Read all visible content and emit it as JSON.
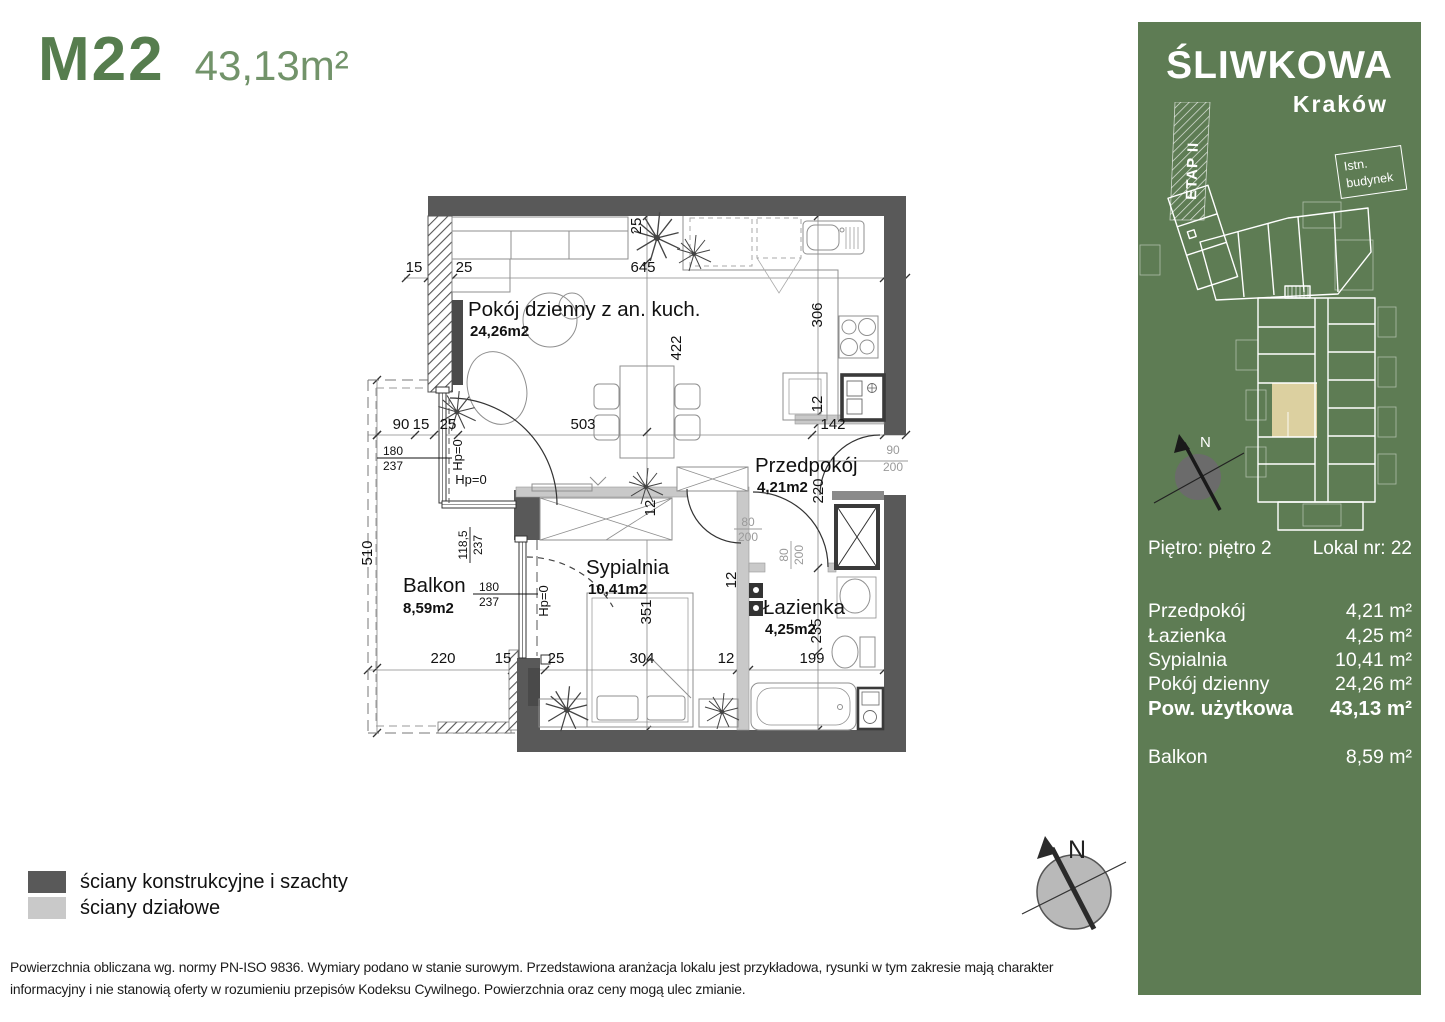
{
  "header": {
    "unit_code": "M22",
    "unit_area": "43,13m²"
  },
  "panel": {
    "project_name": "ŚLIWKOWA",
    "city": "Kraków",
    "etap_label": "ETAP II",
    "existing_line1": "Istn.",
    "existing_line2": "budynek",
    "compass_n": "N",
    "floor_label": "Piętro: piętro 2",
    "lokal_label": "Lokal nr: 22",
    "rooms": [
      {
        "name": "Przedpokój",
        "area": "4,21 m²"
      },
      {
        "name": "Łazienka",
        "area": "4,25 m²"
      },
      {
        "name": "Sypialnia",
        "area": "10,41 m²"
      },
      {
        "name": "Pokój dzienny",
        "area": "24,26 m²"
      }
    ],
    "total": {
      "name": "Pow. użytkowa",
      "area": "43,13 m²"
    },
    "balcony": {
      "name": "Balkon",
      "area": "8,59 m²"
    },
    "colors": {
      "panel_green": "#5e7c54",
      "unit_highlight": "#dcd0a0"
    }
  },
  "plan": {
    "rooms": [
      {
        "name": "Pokój dzienny z an. kuch.",
        "area": "24,26m2"
      },
      {
        "name": "Przedpokój",
        "area": "4,21m2"
      },
      {
        "name": "Sypialnia",
        "area": "10,41m2"
      },
      {
        "name": "Łazienka",
        "area": "4,25m2"
      },
      {
        "name": "Balkon",
        "area": "8,59m2"
      }
    ],
    "dims": [
      "15",
      "25",
      "645",
      "25",
      "422",
      "306",
      "12",
      "142",
      "90",
      "15",
      "25",
      "503",
      "220",
      "510",
      "351",
      "12",
      "12",
      "235",
      "220",
      "15",
      "25",
      "304",
      "12",
      "199"
    ],
    "fracs": [
      {
        "top": "180",
        "bottom": "237"
      },
      {
        "top": "118,5",
        "bottom": "237"
      },
      {
        "top": "180",
        "bottom": "237"
      },
      {
        "top": "90",
        "bottom": "200"
      },
      {
        "top": "80",
        "bottom": "200"
      },
      {
        "top": "80",
        "bottom": "200"
      }
    ],
    "hp": [
      "Hp=0",
      "Hp=0",
      "Hp=0"
    ],
    "compass_n": "N",
    "wall_colors": {
      "structural": "#595959",
      "partition": "#c9c9c9"
    }
  },
  "legend": [
    {
      "label": "ściany konstrukcyjne i szachty",
      "color": "#595959"
    },
    {
      "label": "ściany działowe",
      "color": "#c9c9c9"
    }
  ],
  "footer": {
    "line1": "Powierzchnia obliczana wg. normy PN-ISO 9836. Wymiary podano w stanie surowym. Przedstawiona aranżacja lokalu jest przykładowa, rysunki w tym zakresie mają charakter",
    "line2": "informacyjny i nie stanowią oferty w rozumieniu przepisów Kodeksu Cywilnego. Powierzchnia oraz ceny mogą ulec zmianie."
  }
}
